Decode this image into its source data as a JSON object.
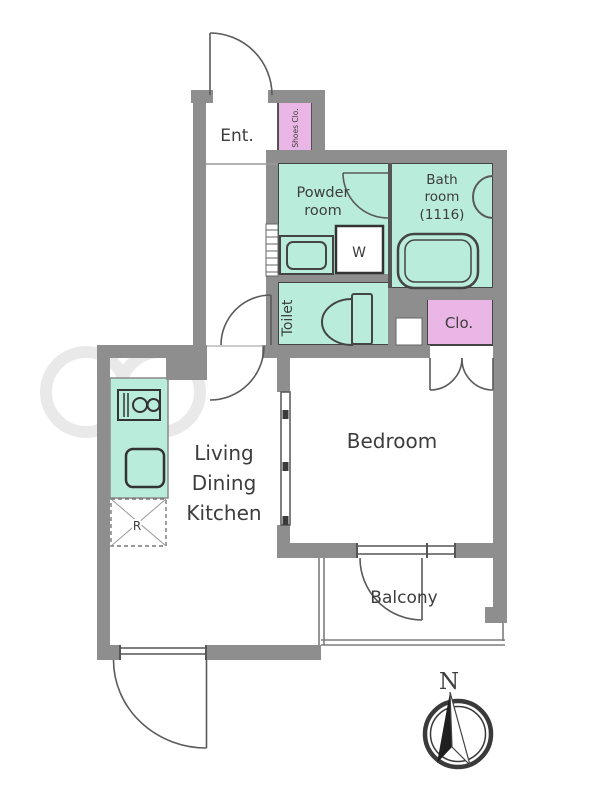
{
  "floorplan": {
    "type": "apartment-floor-plan",
    "colors": {
      "wall_gray": "#8e8e8e",
      "wet_area_mint": "#b9ecdb",
      "closet_pink": "#eab6e6",
      "outline_dark": "#444444",
      "label_text": "#3d3d3d"
    },
    "rooms": {
      "entrance": {
        "label": "Ent."
      },
      "shoes_closet": {
        "label": "Shoes Clo."
      },
      "powder_room": {
        "line1": "Powder",
        "line2": "room"
      },
      "bath_room": {
        "line1": "Bath",
        "line2": "room",
        "line3": "(1116)"
      },
      "toilet": {
        "label": "Toilet"
      },
      "closet": {
        "label": "Clo."
      },
      "living_dining_kitchen": {
        "line1": "Living",
        "line2": "Dining",
        "line3": "Kitchen"
      },
      "bedroom": {
        "label": "Bedroom"
      },
      "balcony": {
        "label": "Balcony"
      }
    },
    "fixtures": {
      "washing_machine": {
        "label": "W"
      },
      "refrigerator_space": {
        "label": "R"
      }
    },
    "compass": {
      "north_label": "N"
    }
  }
}
